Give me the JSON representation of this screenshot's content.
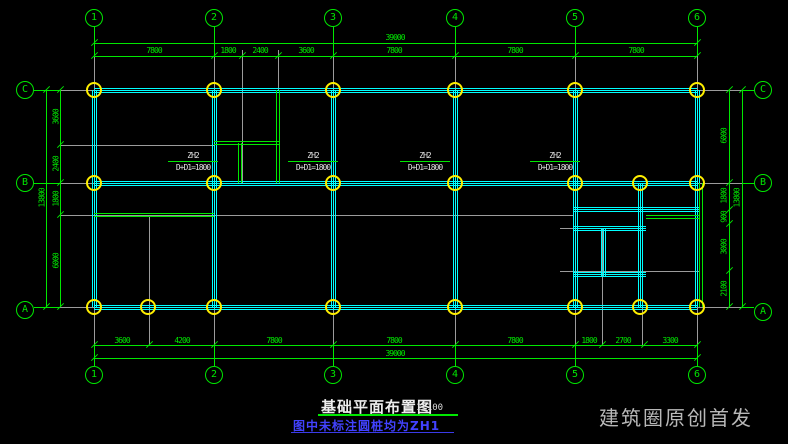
{
  "title_block": {
    "title": "基础平面布置图",
    "scale": "1:100",
    "note": "图中未标注圆桩均为ZH1"
  },
  "watermark": "建筑圈原创首发",
  "axes": {
    "columns": [
      "1",
      "2",
      "3",
      "4",
      "5",
      "6"
    ],
    "rows": [
      "C",
      "B",
      "A"
    ]
  },
  "dims": {
    "top_overall": "39000",
    "top": [
      "7800",
      "1800",
      "2400",
      "3600",
      "7800",
      "7800",
      "7800"
    ],
    "bottom": [
      "3600",
      "4200",
      "7800",
      "7800",
      "7800",
      "1800",
      "2700",
      "3300"
    ],
    "bottom_overall": "39000",
    "left": [
      "3600",
      "2400",
      "1800",
      "6000"
    ],
    "left_overall": "13800",
    "right": [
      "6000",
      "1800",
      "900",
      "3000",
      "2100"
    ],
    "right_overall": "13800"
  },
  "pile_labels": [
    {
      "name": "ZH2",
      "spec": "D+D1=1800"
    },
    {
      "name": "ZH2",
      "spec": "D+D1=1800"
    },
    {
      "name": "ZH2",
      "spec": "D+D1=1800"
    },
    {
      "name": "ZH2",
      "spec": "D+D1=1800"
    }
  ],
  "colors": {
    "line_green": "#00e800",
    "beam_cyan": "#00ffff",
    "pile_yellow": "#ffef00",
    "grid_gray": "#9b9b9b",
    "note_blue": "#4242ff"
  }
}
